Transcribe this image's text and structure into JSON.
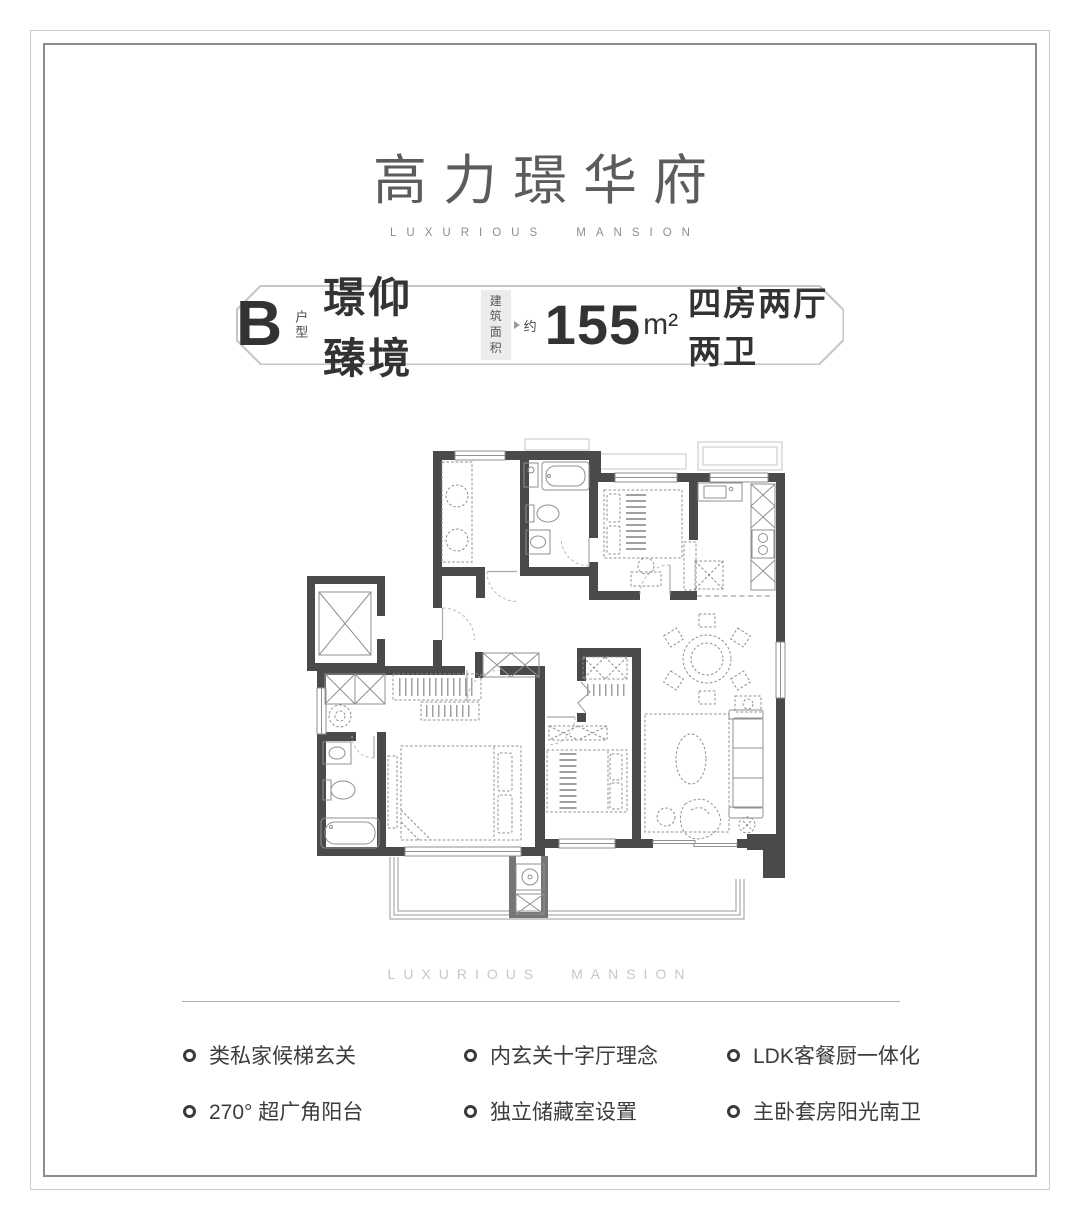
{
  "brand": {
    "title": "高力璟华府",
    "subtitle": "LUXURIOUS MANSION"
  },
  "unit_badge": {
    "unit_letter": "B",
    "unit_label": "户型",
    "unit_name": "璟仰臻境",
    "area_label_line1": "建筑",
    "area_label_line2": "面积",
    "approx_label": "约",
    "area_value": "155",
    "area_unit": "m²",
    "layout_text": "四房两厅两卫"
  },
  "divider": {
    "caption": "LUXURIOUS MANSION"
  },
  "features": {
    "items": [
      "类私家候梯玄关",
      "内玄关十字厅理念",
      "LDK客餐厨一体化",
      "270° 超广角阳台",
      "独立储藏室设置",
      "主卧套房阳光南卫"
    ]
  },
  "colors": {
    "text_dark": "#3a3a3a",
    "text_mid": "#5d5b5b",
    "text_light": "#8f8c8c",
    "divider_line": "#b3aeaa",
    "wall": "#4a4a4a",
    "badge_border": "#c6c6c6"
  }
}
